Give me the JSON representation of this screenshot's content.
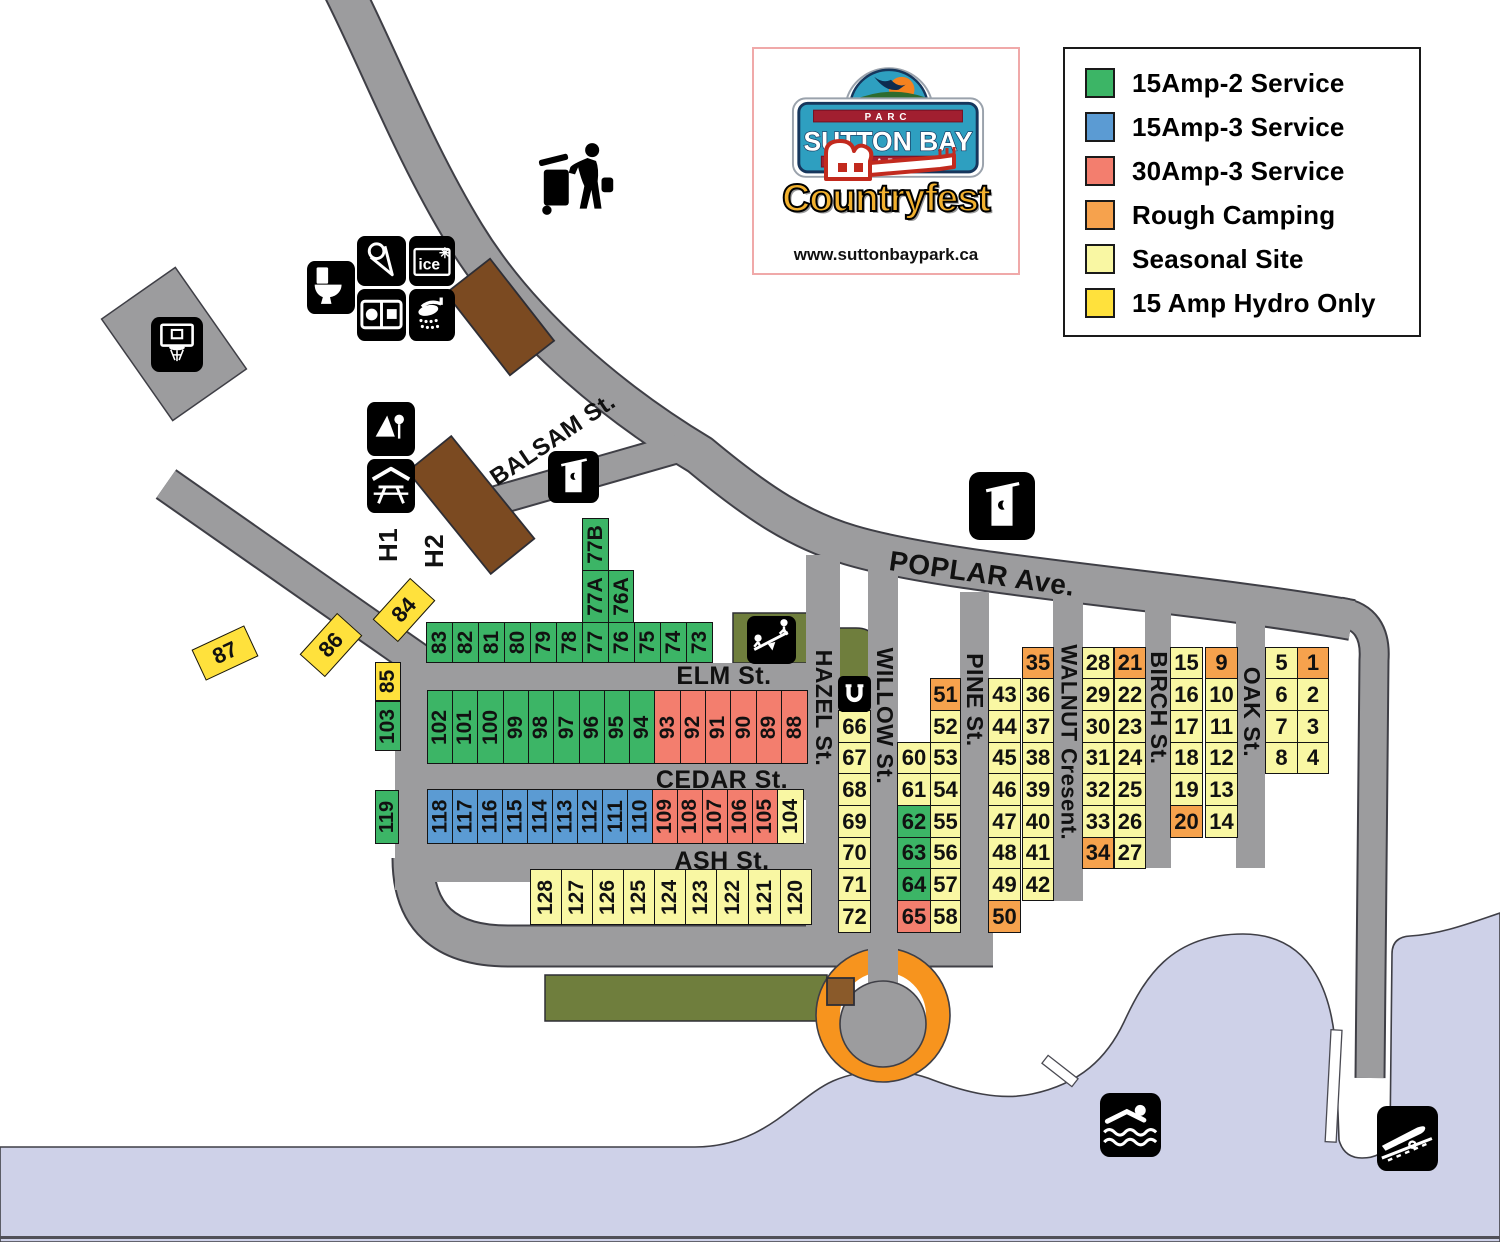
{
  "logo": {
    "parc": "PARC",
    "park_name": "SUTTON BAY",
    "park": "PARK",
    "event": "Countryfest",
    "website": "www.suttonbaypark.ca"
  },
  "legend": {
    "items": [
      {
        "label": "15Amp-2 Service",
        "type": "g"
      },
      {
        "label": "15Amp-3 Service",
        "type": "b"
      },
      {
        "label": "30Amp-3 Service",
        "type": "r"
      },
      {
        "label": "Rough Camping",
        "type": "o"
      },
      {
        "label": "Seasonal Site",
        "type": "p"
      },
      {
        "label": "15 Amp Hydro Only",
        "type": "y"
      }
    ]
  },
  "site_colors": {
    "g": "#3cb566",
    "b": "#5b9bd3",
    "r": "#f37e6e",
    "o": "#f6a24d",
    "p": "#f9f7a3",
    "y": "#ffe13c"
  },
  "map_colors": {
    "road": "#9c9c9e",
    "road_outline": "#3f3f46",
    "water": "#ced1e8",
    "olive": "#6f7e3d",
    "brown": "#7b4a21",
    "brown_small": "#8a5a2a",
    "ring_orange": "#f7941e"
  },
  "streets": [
    {
      "name": "ELM St.",
      "cx": 724,
      "cy": 676,
      "size": 25,
      "rot": 0
    },
    {
      "name": "CEDAR St.",
      "cx": 722,
      "cy": 780,
      "size": 25,
      "rot": 0
    },
    {
      "name": "ASH St.",
      "cx": 722,
      "cy": 861,
      "size": 25,
      "rot": 0
    },
    {
      "name": "POPLAR Ave.",
      "cx": 982,
      "cy": 574,
      "size": 28,
      "rot": 8
    },
    {
      "name": "BALSAM St.",
      "cx": 553,
      "cy": 440,
      "size": 24,
      "rot": -34
    },
    {
      "name": "HAZEL St.",
      "cx": 823,
      "cy": 708,
      "size": 23,
      "rot": 90
    },
    {
      "name": "WILLOW St.",
      "cx": 884,
      "cy": 716,
      "size": 23,
      "rot": 90
    },
    {
      "name": "PINE St.",
      "cx": 974,
      "cy": 700,
      "size": 23,
      "rot": 90
    },
    {
      "name": "WALNUT Cresent.",
      "cx": 1068,
      "cy": 742,
      "size": 22,
      "rot": 90
    },
    {
      "name": "BIRCH St.",
      "cx": 1158,
      "cy": 708,
      "size": 23,
      "rot": 90
    },
    {
      "name": "OAK St.",
      "cx": 1251,
      "cy": 712,
      "size": 23,
      "rot": 90
    },
    {
      "name": "H1",
      "cx": 389,
      "cy": 545,
      "size": 26,
      "rot": -90
    },
    {
      "name": "H2",
      "cx": 435,
      "cy": 551,
      "size": 26,
      "rot": -90
    }
  ],
  "icons": [
    {
      "name": "trash-disposal-icon",
      "x": 536,
      "y": 140,
      "w": 78,
      "h": 78,
      "bare": true
    },
    {
      "name": "basketball-hoop-icon",
      "x": 151,
      "y": 317,
      "w": 52,
      "h": 55
    },
    {
      "name": "toilet-icon",
      "x": 307,
      "y": 261,
      "w": 48,
      "h": 53
    },
    {
      "name": "ice-cream-icon",
      "x": 357,
      "y": 236,
      "w": 49,
      "h": 50
    },
    {
      "name": "ice-icon",
      "x": 409,
      "y": 236,
      "w": 46,
      "h": 50
    },
    {
      "name": "laundry-icon",
      "x": 357,
      "y": 289,
      "w": 49,
      "h": 52
    },
    {
      "name": "shower-icon",
      "x": 409,
      "y": 289,
      "w": 46,
      "h": 52
    },
    {
      "name": "playground-icon",
      "x": 367,
      "y": 402,
      "w": 48,
      "h": 54
    },
    {
      "name": "picnic-shelter-icon",
      "x": 367,
      "y": 459,
      "w": 48,
      "h": 54
    },
    {
      "name": "outhouse-icon-small",
      "x": 548,
      "y": 451,
      "w": 51,
      "h": 52
    },
    {
      "name": "outhouse-icon-large",
      "x": 969,
      "y": 472,
      "w": 66,
      "h": 68
    },
    {
      "name": "seesaw-icon",
      "x": 747,
      "y": 616,
      "w": 49,
      "h": 48
    },
    {
      "name": "horseshoe-icon",
      "x": 838,
      "y": 676,
      "w": 33,
      "h": 36
    },
    {
      "name": "swimming-icon",
      "x": 1100,
      "y": 1093,
      "w": 61,
      "h": 64
    },
    {
      "name": "boat-launch-icon",
      "x": 1377,
      "y": 1106,
      "w": 61,
      "h": 65
    }
  ],
  "sites": [
    {
      "n": "83",
      "x": 426,
      "y": 622,
      "w": 27,
      "h": 41,
      "t": "g",
      "v": 1
    },
    {
      "n": "82",
      "x": 452,
      "y": 622,
      "w": 27,
      "h": 41,
      "t": "g",
      "v": 1
    },
    {
      "n": "81",
      "x": 478,
      "y": 622,
      "w": 27,
      "h": 41,
      "t": "g",
      "v": 1
    },
    {
      "n": "80",
      "x": 504,
      "y": 622,
      "w": 27,
      "h": 41,
      "t": "g",
      "v": 1
    },
    {
      "n": "79",
      "x": 530,
      "y": 622,
      "w": 27,
      "h": 41,
      "t": "g",
      "v": 1
    },
    {
      "n": "78",
      "x": 556,
      "y": 622,
      "w": 27,
      "h": 41,
      "t": "g",
      "v": 1
    },
    {
      "n": "77",
      "x": 582,
      "y": 622,
      "w": 27,
      "h": 41,
      "t": "g",
      "v": 1
    },
    {
      "n": "76",
      "x": 608,
      "y": 622,
      "w": 27,
      "h": 41,
      "t": "g",
      "v": 1
    },
    {
      "n": "75",
      "x": 634,
      "y": 622,
      "w": 27,
      "h": 41,
      "t": "g",
      "v": 1
    },
    {
      "n": "74",
      "x": 660,
      "y": 622,
      "w": 27,
      "h": 41,
      "t": "g",
      "v": 1
    },
    {
      "n": "73",
      "x": 686,
      "y": 622,
      "w": 27,
      "h": 41,
      "t": "g",
      "v": 1
    },
    {
      "n": "77B",
      "x": 582,
      "y": 518,
      "w": 27,
      "h": 53,
      "t": "g",
      "v": 1
    },
    {
      "n": "77A",
      "x": 582,
      "y": 570,
      "w": 27,
      "h": 53,
      "t": "g",
      "v": 1
    },
    {
      "n": "76A",
      "x": 608,
      "y": 570,
      "w": 26,
      "h": 53,
      "t": "g",
      "v": 1
    },
    {
      "n": "85",
      "x": 375,
      "y": 662,
      "w": 26,
      "h": 39,
      "t": "y",
      "v": 1
    },
    {
      "n": "103",
      "x": 375,
      "y": 701,
      "w": 26,
      "h": 50,
      "t": "g",
      "v": 1
    },
    {
      "n": "102",
      "x": 427,
      "y": 690,
      "w": 26,
      "h": 74,
      "t": "g",
      "v": 1
    },
    {
      "n": "101",
      "x": 452,
      "y": 690,
      "w": 26,
      "h": 74,
      "t": "g",
      "v": 1
    },
    {
      "n": "100",
      "x": 477,
      "y": 690,
      "w": 27,
      "h": 74,
      "t": "g",
      "v": 1
    },
    {
      "n": "99",
      "x": 503,
      "y": 690,
      "w": 26,
      "h": 74,
      "t": "g",
      "v": 1
    },
    {
      "n": "98",
      "x": 528,
      "y": 690,
      "w": 26,
      "h": 74,
      "t": "g",
      "v": 1
    },
    {
      "n": "97",
      "x": 553,
      "y": 690,
      "w": 27,
      "h": 74,
      "t": "g",
      "v": 1
    },
    {
      "n": "96",
      "x": 579,
      "y": 690,
      "w": 26,
      "h": 74,
      "t": "g",
      "v": 1
    },
    {
      "n": "95",
      "x": 604,
      "y": 690,
      "w": 26,
      "h": 74,
      "t": "g",
      "v": 1
    },
    {
      "n": "94",
      "x": 629,
      "y": 690,
      "w": 26,
      "h": 74,
      "t": "g",
      "v": 1
    },
    {
      "n": "93",
      "x": 654,
      "y": 690,
      "w": 27,
      "h": 74,
      "t": "r",
      "v": 1
    },
    {
      "n": "92",
      "x": 680,
      "y": 690,
      "w": 26,
      "h": 74,
      "t": "r",
      "v": 1
    },
    {
      "n": "91",
      "x": 705,
      "y": 690,
      "w": 26,
      "h": 74,
      "t": "r",
      "v": 1
    },
    {
      "n": "90",
      "x": 730,
      "y": 690,
      "w": 27,
      "h": 74,
      "t": "r",
      "v": 1
    },
    {
      "n": "89",
      "x": 756,
      "y": 690,
      "w": 26,
      "h": 74,
      "t": "r",
      "v": 1
    },
    {
      "n": "88",
      "x": 781,
      "y": 690,
      "w": 27,
      "h": 74,
      "t": "r",
      "v": 1
    },
    {
      "n": "119",
      "x": 375,
      "y": 790,
      "w": 24,
      "h": 54,
      "t": "g",
      "v": 1
    },
    {
      "n": "118",
      "x": 427,
      "y": 789,
      "w": 26,
      "h": 55,
      "t": "b",
      "v": 1
    },
    {
      "n": "117",
      "x": 452,
      "y": 789,
      "w": 26,
      "h": 55,
      "t": "b",
      "v": 1
    },
    {
      "n": "116",
      "x": 477,
      "y": 789,
      "w": 26,
      "h": 55,
      "t": "b",
      "v": 1
    },
    {
      "n": "115",
      "x": 502,
      "y": 789,
      "w": 26,
      "h": 55,
      "t": "b",
      "v": 1
    },
    {
      "n": "114",
      "x": 527,
      "y": 789,
      "w": 26,
      "h": 55,
      "t": "b",
      "v": 1
    },
    {
      "n": "113",
      "x": 552,
      "y": 789,
      "w": 26,
      "h": 55,
      "t": "b",
      "v": 1
    },
    {
      "n": "112",
      "x": 577,
      "y": 789,
      "w": 26,
      "h": 55,
      "t": "b",
      "v": 1
    },
    {
      "n": "111",
      "x": 602,
      "y": 789,
      "w": 26,
      "h": 55,
      "t": "b",
      "v": 1
    },
    {
      "n": "110",
      "x": 627,
      "y": 789,
      "w": 26,
      "h": 55,
      "t": "b",
      "v": 1
    },
    {
      "n": "109",
      "x": 652,
      "y": 789,
      "w": 26,
      "h": 55,
      "t": "r",
      "v": 1
    },
    {
      "n": "108",
      "x": 677,
      "y": 789,
      "w": 26,
      "h": 55,
      "t": "r",
      "v": 1
    },
    {
      "n": "107",
      "x": 702,
      "y": 789,
      "w": 26,
      "h": 55,
      "t": "r",
      "v": 1
    },
    {
      "n": "106",
      "x": 727,
      "y": 789,
      "w": 26,
      "h": 55,
      "t": "r",
      "v": 1
    },
    {
      "n": "105",
      "x": 752,
      "y": 789,
      "w": 26,
      "h": 55,
      "t": "r",
      "v": 1
    },
    {
      "n": "104",
      "x": 777,
      "y": 789,
      "w": 27,
      "h": 55,
      "t": "p",
      "v": 1
    },
    {
      "n": "128",
      "x": 530,
      "y": 869,
      "w": 32,
      "h": 56,
      "t": "p",
      "v": 1
    },
    {
      "n": "127",
      "x": 561,
      "y": 869,
      "w": 32,
      "h": 56,
      "t": "p",
      "v": 1
    },
    {
      "n": "126",
      "x": 592,
      "y": 869,
      "w": 32,
      "h": 56,
      "t": "p",
      "v": 1
    },
    {
      "n": "125",
      "x": 623,
      "y": 869,
      "w": 32,
      "h": 56,
      "t": "p",
      "v": 1
    },
    {
      "n": "124",
      "x": 654,
      "y": 869,
      "w": 32,
      "h": 56,
      "t": "p",
      "v": 1
    },
    {
      "n": "123",
      "x": 685,
      "y": 869,
      "w": 32,
      "h": 56,
      "t": "p",
      "v": 1
    },
    {
      "n": "122",
      "x": 716,
      "y": 869,
      "w": 33,
      "h": 56,
      "t": "p",
      "v": 1
    },
    {
      "n": "121",
      "x": 748,
      "y": 869,
      "w": 33,
      "h": 56,
      "t": "p",
      "v": 1
    },
    {
      "n": "120",
      "x": 780,
      "y": 869,
      "w": 32,
      "h": 56,
      "t": "p",
      "v": 1
    },
    {
      "n": "87",
      "x": 196,
      "y": 636,
      "w": 58,
      "h": 34,
      "t": "y",
      "rot": -25
    },
    {
      "n": "86",
      "x": 303,
      "y": 628,
      "w": 56,
      "h": 34,
      "t": "y",
      "rot": -48
    },
    {
      "n": "84",
      "x": 376,
      "y": 593,
      "w": 56,
      "h": 34,
      "t": "y",
      "rot": -48
    },
    {
      "n": "66",
      "x": 838,
      "y": 710,
      "w": 33,
      "h": 33,
      "t": "p"
    },
    {
      "n": "67",
      "x": 838,
      "y": 742,
      "w": 33,
      "h": 32,
      "t": "p"
    },
    {
      "n": "68",
      "x": 838,
      "y": 773,
      "w": 33,
      "h": 33,
      "t": "p"
    },
    {
      "n": "69",
      "x": 838,
      "y": 805,
      "w": 33,
      "h": 33,
      "t": "p"
    },
    {
      "n": "70",
      "x": 838,
      "y": 837,
      "w": 33,
      "h": 32,
      "t": "p"
    },
    {
      "n": "71",
      "x": 838,
      "y": 868,
      "w": 33,
      "h": 33,
      "t": "p"
    },
    {
      "n": "72",
      "x": 838,
      "y": 900,
      "w": 33,
      "h": 33,
      "t": "p"
    },
    {
      "n": "60",
      "x": 897,
      "y": 742,
      "w": 34,
      "h": 32,
      "t": "p"
    },
    {
      "n": "61",
      "x": 897,
      "y": 773,
      "w": 34,
      "h": 33,
      "t": "p"
    },
    {
      "n": "62",
      "x": 897,
      "y": 805,
      "w": 34,
      "h": 33,
      "t": "g"
    },
    {
      "n": "63",
      "x": 897,
      "y": 837,
      "w": 34,
      "h": 32,
      "t": "g"
    },
    {
      "n": "64",
      "x": 897,
      "y": 868,
      "w": 34,
      "h": 33,
      "t": "g"
    },
    {
      "n": "65",
      "x": 897,
      "y": 900,
      "w": 34,
      "h": 33,
      "t": "r"
    },
    {
      "n": "51",
      "x": 930,
      "y": 678,
      "w": 31,
      "h": 33,
      "t": "o"
    },
    {
      "n": "52",
      "x": 930,
      "y": 710,
      "w": 31,
      "h": 33,
      "t": "p"
    },
    {
      "n": "53",
      "x": 930,
      "y": 742,
      "w": 31,
      "h": 32,
      "t": "p"
    },
    {
      "n": "54",
      "x": 930,
      "y": 773,
      "w": 31,
      "h": 33,
      "t": "p"
    },
    {
      "n": "55",
      "x": 930,
      "y": 805,
      "w": 31,
      "h": 33,
      "t": "p"
    },
    {
      "n": "56",
      "x": 930,
      "y": 837,
      "w": 31,
      "h": 32,
      "t": "p"
    },
    {
      "n": "57",
      "x": 930,
      "y": 868,
      "w": 31,
      "h": 33,
      "t": "p"
    },
    {
      "n": "58",
      "x": 930,
      "y": 900,
      "w": 31,
      "h": 33,
      "t": "p"
    },
    {
      "n": "43",
      "x": 988,
      "y": 678,
      "w": 33,
      "h": 33,
      "t": "p"
    },
    {
      "n": "44",
      "x": 988,
      "y": 710,
      "w": 33,
      "h": 33,
      "t": "p"
    },
    {
      "n": "45",
      "x": 988,
      "y": 742,
      "w": 33,
      "h": 32,
      "t": "p"
    },
    {
      "n": "46",
      "x": 988,
      "y": 773,
      "w": 33,
      "h": 33,
      "t": "p"
    },
    {
      "n": "47",
      "x": 988,
      "y": 805,
      "w": 33,
      "h": 33,
      "t": "p"
    },
    {
      "n": "48",
      "x": 988,
      "y": 837,
      "w": 33,
      "h": 32,
      "t": "p"
    },
    {
      "n": "49",
      "x": 988,
      "y": 868,
      "w": 33,
      "h": 33,
      "t": "p"
    },
    {
      "n": "50",
      "x": 988,
      "y": 900,
      "w": 33,
      "h": 33,
      "t": "o"
    },
    {
      "n": "35",
      "x": 1022,
      "y": 647,
      "w": 32,
      "h": 32,
      "t": "o"
    },
    {
      "n": "36",
      "x": 1022,
      "y": 678,
      "w": 32,
      "h": 33,
      "t": "p"
    },
    {
      "n": "37",
      "x": 1022,
      "y": 710,
      "w": 32,
      "h": 33,
      "t": "p"
    },
    {
      "n": "38",
      "x": 1022,
      "y": 742,
      "w": 32,
      "h": 32,
      "t": "p"
    },
    {
      "n": "39",
      "x": 1022,
      "y": 773,
      "w": 32,
      "h": 33,
      "t": "p"
    },
    {
      "n": "40",
      "x": 1022,
      "y": 805,
      "w": 32,
      "h": 33,
      "t": "p"
    },
    {
      "n": "41",
      "x": 1022,
      "y": 837,
      "w": 32,
      "h": 32,
      "t": "p"
    },
    {
      "n": "42",
      "x": 1022,
      "y": 868,
      "w": 32,
      "h": 33,
      "t": "p"
    },
    {
      "n": "28",
      "x": 1082,
      "y": 647,
      "w": 32,
      "h": 32,
      "t": "p"
    },
    {
      "n": "29",
      "x": 1082,
      "y": 678,
      "w": 32,
      "h": 33,
      "t": "p"
    },
    {
      "n": "30",
      "x": 1082,
      "y": 710,
      "w": 32,
      "h": 33,
      "t": "p"
    },
    {
      "n": "31",
      "x": 1082,
      "y": 742,
      "w": 32,
      "h": 32,
      "t": "p"
    },
    {
      "n": "32",
      "x": 1082,
      "y": 773,
      "w": 32,
      "h": 33,
      "t": "p"
    },
    {
      "n": "33",
      "x": 1082,
      "y": 805,
      "w": 32,
      "h": 33,
      "t": "p"
    },
    {
      "n": "34",
      "x": 1082,
      "y": 837,
      "w": 32,
      "h": 32,
      "t": "o"
    },
    {
      "n": "21",
      "x": 1114,
      "y": 647,
      "w": 32,
      "h": 32,
      "t": "o"
    },
    {
      "n": "22",
      "x": 1114,
      "y": 678,
      "w": 32,
      "h": 33,
      "t": "p"
    },
    {
      "n": "23",
      "x": 1114,
      "y": 710,
      "w": 32,
      "h": 33,
      "t": "p"
    },
    {
      "n": "24",
      "x": 1114,
      "y": 742,
      "w": 32,
      "h": 32,
      "t": "p"
    },
    {
      "n": "25",
      "x": 1114,
      "y": 773,
      "w": 32,
      "h": 33,
      "t": "p"
    },
    {
      "n": "26",
      "x": 1114,
      "y": 805,
      "w": 32,
      "h": 33,
      "t": "p"
    },
    {
      "n": "27",
      "x": 1114,
      "y": 837,
      "w": 32,
      "h": 32,
      "t": "p"
    },
    {
      "n": "15",
      "x": 1170,
      "y": 647,
      "w": 33,
      "h": 32,
      "t": "p"
    },
    {
      "n": "16",
      "x": 1170,
      "y": 678,
      "w": 33,
      "h": 33,
      "t": "p"
    },
    {
      "n": "17",
      "x": 1170,
      "y": 710,
      "w": 33,
      "h": 33,
      "t": "p"
    },
    {
      "n": "18",
      "x": 1170,
      "y": 742,
      "w": 33,
      "h": 32,
      "t": "p"
    },
    {
      "n": "19",
      "x": 1170,
      "y": 773,
      "w": 33,
      "h": 33,
      "t": "p"
    },
    {
      "n": "20",
      "x": 1170,
      "y": 805,
      "w": 33,
      "h": 33,
      "t": "o"
    },
    {
      "n": "9",
      "x": 1205,
      "y": 647,
      "w": 33,
      "h": 32,
      "t": "o"
    },
    {
      "n": "10",
      "x": 1205,
      "y": 678,
      "w": 33,
      "h": 33,
      "t": "p"
    },
    {
      "n": "11",
      "x": 1205,
      "y": 710,
      "w": 33,
      "h": 33,
      "t": "p"
    },
    {
      "n": "12",
      "x": 1205,
      "y": 742,
      "w": 33,
      "h": 32,
      "t": "p"
    },
    {
      "n": "13",
      "x": 1205,
      "y": 773,
      "w": 33,
      "h": 33,
      "t": "p"
    },
    {
      "n": "14",
      "x": 1205,
      "y": 805,
      "w": 33,
      "h": 33,
      "t": "p"
    },
    {
      "n": "5",
      "x": 1265,
      "y": 647,
      "w": 33,
      "h": 32,
      "t": "p"
    },
    {
      "n": "6",
      "x": 1265,
      "y": 678,
      "w": 33,
      "h": 33,
      "t": "p"
    },
    {
      "n": "7",
      "x": 1265,
      "y": 710,
      "w": 33,
      "h": 33,
      "t": "p"
    },
    {
      "n": "8",
      "x": 1265,
      "y": 742,
      "w": 33,
      "h": 32,
      "t": "p"
    },
    {
      "n": "1",
      "x": 1297,
      "y": 647,
      "w": 32,
      "h": 32,
      "t": "o"
    },
    {
      "n": "2",
      "x": 1297,
      "y": 678,
      "w": 32,
      "h": 33,
      "t": "p"
    },
    {
      "n": "3",
      "x": 1297,
      "y": 710,
      "w": 32,
      "h": 33,
      "t": "p"
    },
    {
      "n": "4",
      "x": 1297,
      "y": 742,
      "w": 32,
      "h": 32,
      "t": "p"
    }
  ]
}
